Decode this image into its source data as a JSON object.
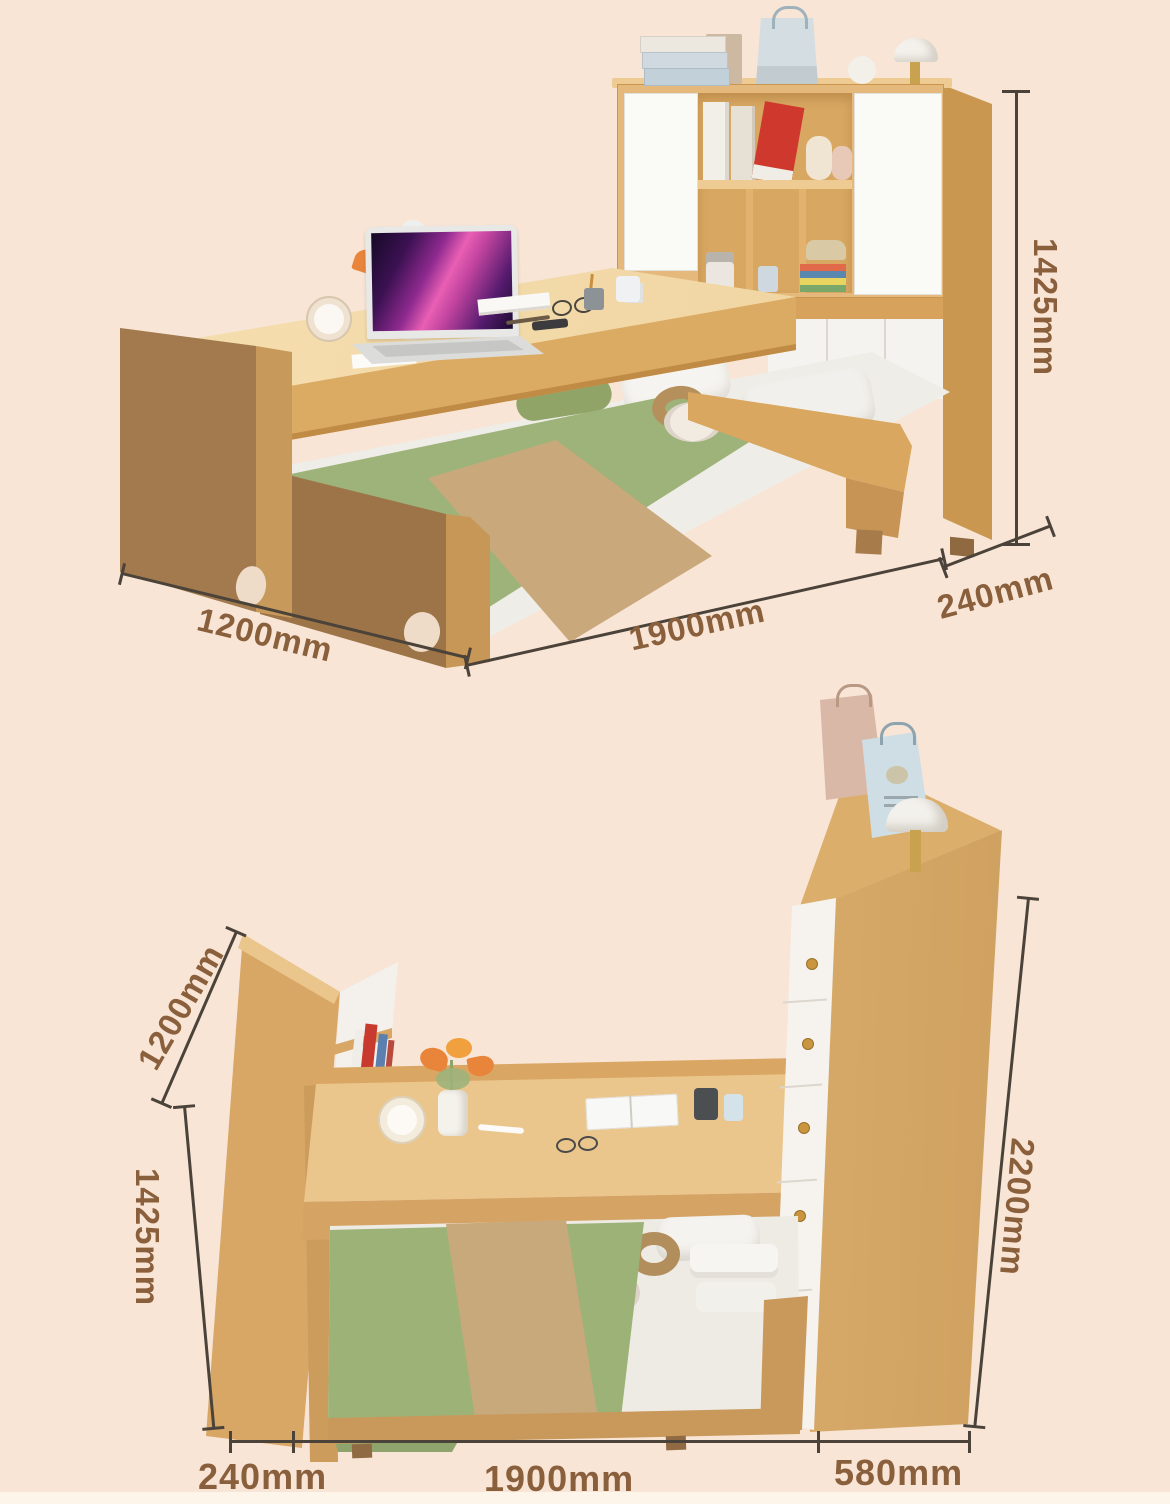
{
  "page": {
    "description": "Furniture product dimension diagram: multifunctional bed with sliding desk, bookshelf headboard and wardrobe, shown in two views with measurements",
    "background_color": "#f8e5d6",
    "footer_strip_color": "#fdf4ea"
  },
  "colors": {
    "dimension_text": "#8a5f3c",
    "dimension_line": "#4b4339",
    "wood_light": "#e5b97b",
    "wood_mid": "#d8a761",
    "wood_dark": "#a27a4e",
    "panel_white": "#f6f3ee",
    "bedding_green": "#9eb379",
    "blanket_tan": "#c9a97b",
    "laptop_screen_accent": "#e95fb4"
  },
  "top_view": {
    "name": "side view - desk over pull-out bed with bookshelf hutch",
    "dim_height": "1425mm",
    "dim_width": "1200mm",
    "dim_length": "1900mm",
    "dim_depth": "240mm"
  },
  "bottom_view": {
    "name": "front view - headboard shelf, desk, pull-out bed and wardrobe",
    "dim_shelf_width": "1200mm",
    "dim_shelf_height": "1425mm",
    "dim_wardrobe_height": "2200mm",
    "dim_base_depth": "240mm",
    "dim_base_length": "1900mm",
    "dim_wardrobe_depth": "580mm"
  }
}
